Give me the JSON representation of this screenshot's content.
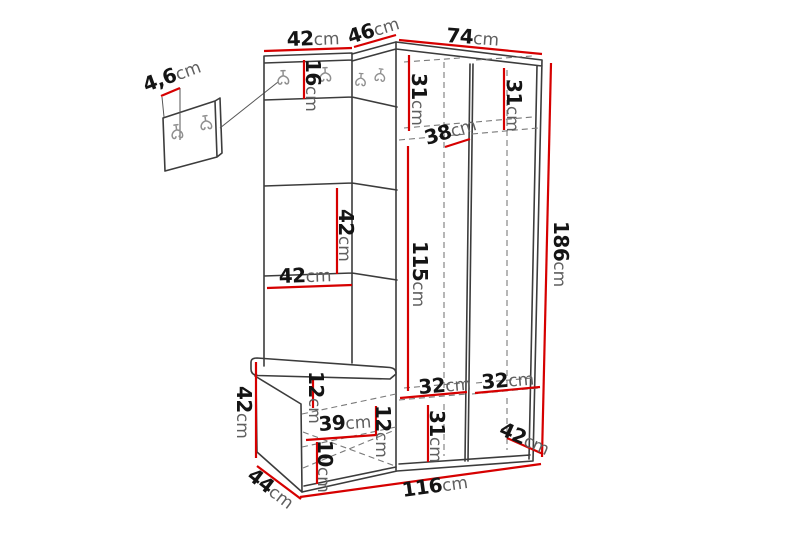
{
  "figure": {
    "type": "furniture-dimension-diagram",
    "subject": "hallway corner wardrobe set with bench and wall hook panel",
    "unit": "cm"
  },
  "colors": {
    "background": "#ffffff",
    "dimension_red": "#d60000",
    "outline_dark": "#3c3c3c",
    "dashed_gray": "#7a7a7a",
    "number_text": "#141414",
    "unit_text": "#5f5f5f"
  },
  "dims": {
    "top_width_left": {
      "value": "42",
      "unit": "cm"
    },
    "corner_width": {
      "value": "46",
      "unit": "cm"
    },
    "wardrobe_width": {
      "value": "74",
      "unit": "cm"
    },
    "hook_rail_height": {
      "value": "16",
      "unit": "cm"
    },
    "wall_panel_depth": {
      "value": "4,6",
      "unit": "cm"
    },
    "panel_section_height": {
      "value": "42",
      "unit": "cm"
    },
    "panel_section_width": {
      "value": "42",
      "unit": "cm"
    },
    "top_shelf_left_height": {
      "value": "31",
      "unit": "cm"
    },
    "top_shelf_right_height": {
      "value": "31",
      "unit": "cm"
    },
    "top_shelf_depth": {
      "value": "38",
      "unit": "cm"
    },
    "door_height": {
      "value": "115",
      "unit": "cm"
    },
    "total_height": {
      "value": "186",
      "unit": "cm"
    },
    "bench_height": {
      "value": "42",
      "unit": "cm"
    },
    "bench_top_clearance": {
      "value": "12",
      "unit": "cm"
    },
    "bench_inner_width": {
      "value": "39",
      "unit": "cm"
    },
    "bench_right_clearance": {
      "value": "12",
      "unit": "cm"
    },
    "bench_bottom_clearance": {
      "value": "10",
      "unit": "cm"
    },
    "bench_depth": {
      "value": "44",
      "unit": "cm"
    },
    "total_width": {
      "value": "116",
      "unit": "cm"
    },
    "bottom_left_width": {
      "value": "32",
      "unit": "cm"
    },
    "bottom_right_width": {
      "value": "32",
      "unit": "cm"
    },
    "bottom_section_height": {
      "value": "31",
      "unit": "cm"
    },
    "wardrobe_depth": {
      "value": "42",
      "unit": "cm"
    }
  }
}
